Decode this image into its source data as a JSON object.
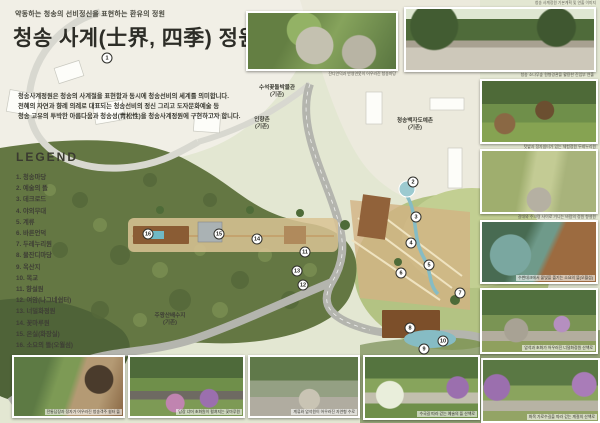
{
  "board": {
    "subtitle": "약동하는 청송의 선비정신을 표현하는 환유의 정원",
    "title": "청송 사계(士界, 四季) 정원",
    "description": [
      "청송사계정원은 청송의 사계절을 표현함과 동시에 청송선비의 세계를 의미합니다.",
      "천혜의 자연과 향례 의례로 대표되는 청송선비의 정신 그리고 도자문화예술 등",
      "청송 고유의 투박한 아름다움과 청송성(靑松性)을 청송사계정원에 구현하고자 합니다."
    ],
    "corner_note": "청송 사계정원 기본계획 및 연출 이미지"
  },
  "legend": {
    "heading": "LEGEND",
    "items": [
      "1. 청송마당",
      "2. 예술의 뜰",
      "3. 데크로드",
      "4. 야외무대",
      "5. 계류",
      "6. 바른언덕",
      "7. 두레누리원",
      "8. 물잔디마당",
      "9. 옥산지",
      "10. 목교",
      "11. 향설원",
      "12. 여암(나그네쉼터)",
      "13. 너덜화정원",
      "14. 꽃마루원",
      "15. 온실(화장실)",
      "16. 소요의 뜰(오월섬)"
    ]
  },
  "plan": {
    "labels": [
      {
        "name": "수석꽃돌박물관",
        "note": "(기존)"
      },
      {
        "name": "인향촌",
        "note": "(기존)"
      },
      {
        "name": "청송백자도예촌",
        "note": "(기존)"
      },
      {
        "name": "주왕산배수지",
        "note": "(기존)"
      }
    ],
    "markers": [
      {
        "n": "1"
      },
      {
        "n": "2"
      },
      {
        "n": "3"
      },
      {
        "n": "4"
      },
      {
        "n": "5"
      },
      {
        "n": "6"
      },
      {
        "n": "7"
      },
      {
        "n": "8"
      },
      {
        "n": "9"
      },
      {
        "n": "10"
      },
      {
        "n": "11"
      },
      {
        "n": "12"
      },
      {
        "n": "13"
      },
      {
        "n": "14"
      },
      {
        "n": "15"
      },
      {
        "n": "16"
      }
    ]
  },
  "photos": {
    "top": [
      {
        "caption": "잔디언덕과 반영연못이 어우러진 청송마당"
      },
      {
        "caption": "청송 소나무숲 원형경관을 활용한 진입부 연출"
      }
    ],
    "right": [
      {
        "caption": "텃밭과 정자쉼터가 있는 체험정원 두레누리원"
      },
      {
        "caption": "갈대와 수크령 사이로 거니는 바람의 정원 향설원"
      },
      {
        "caption": "수변데크에서 물빛을 즐기는 소요의 뜰(오월섬)"
      },
      {
        "caption": "암석과 초화가 어우러진 너덜화정원 산책로"
      },
      {
        "caption": "화목 가로수길을 따라 걷는 계절의 산책로"
      }
    ],
    "bottom": [
      {
        "caption": "전통담장과 정자가 어우러진 청송객주 쉼터 뜰"
      },
      {
        "caption": "담장 너머 초화원이 펼쳐지는 꽃마루원"
      },
      {
        "caption": "계류와 암석원이 어우러진 자연형 수로"
      },
      {
        "caption": "수국길 따라 걷는 예술의 뜰 산책로"
      }
    ]
  }
}
